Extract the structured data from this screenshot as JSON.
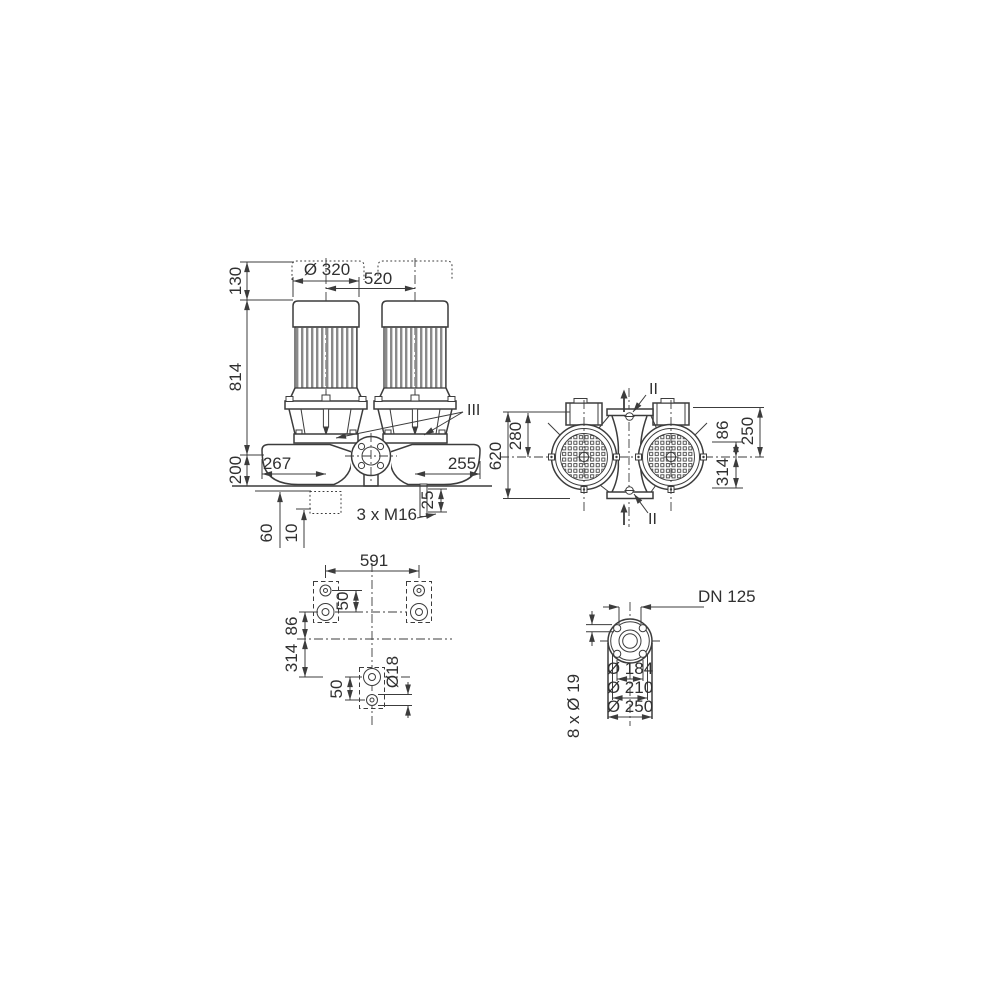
{
  "colors": {
    "line": "#3c3c3c",
    "background": "#ffffff",
    "fin_gray": "#8a8a8a"
  },
  "front_view": {
    "dim_clearance": "130",
    "dim_height": "814",
    "dim_base": "200",
    "dim_motor_dia": "Ø 320",
    "dim_spacing": "520",
    "dim_left": "267",
    "dim_right": "255",
    "dim_drain": "25",
    "label_tappings": "3 x M16",
    "dim_foundation": "60",
    "dim_shim": "10",
    "section_label": "III"
  },
  "top_view": {
    "dim_total": "620",
    "dim_port_top": "280",
    "dim_foot_near": "86",
    "dim_depth": "250",
    "dim_foot_far": "314",
    "section_top": "II",
    "section_bottom": "II"
  },
  "foundation_view": {
    "dim_span": "591",
    "dim_pitch_upper": "50",
    "dim_row_near": "86",
    "dim_row_far": "314",
    "dim_pitch_lower": "50",
    "dim_hole": "Ø18"
  },
  "flange_view": {
    "label_nominal": "DN 125",
    "dim_face": "Ø 184",
    "dim_bolt_circle": "Ø 210",
    "dim_outer": "Ø 250",
    "label_holes": "8 x Ø 19"
  }
}
